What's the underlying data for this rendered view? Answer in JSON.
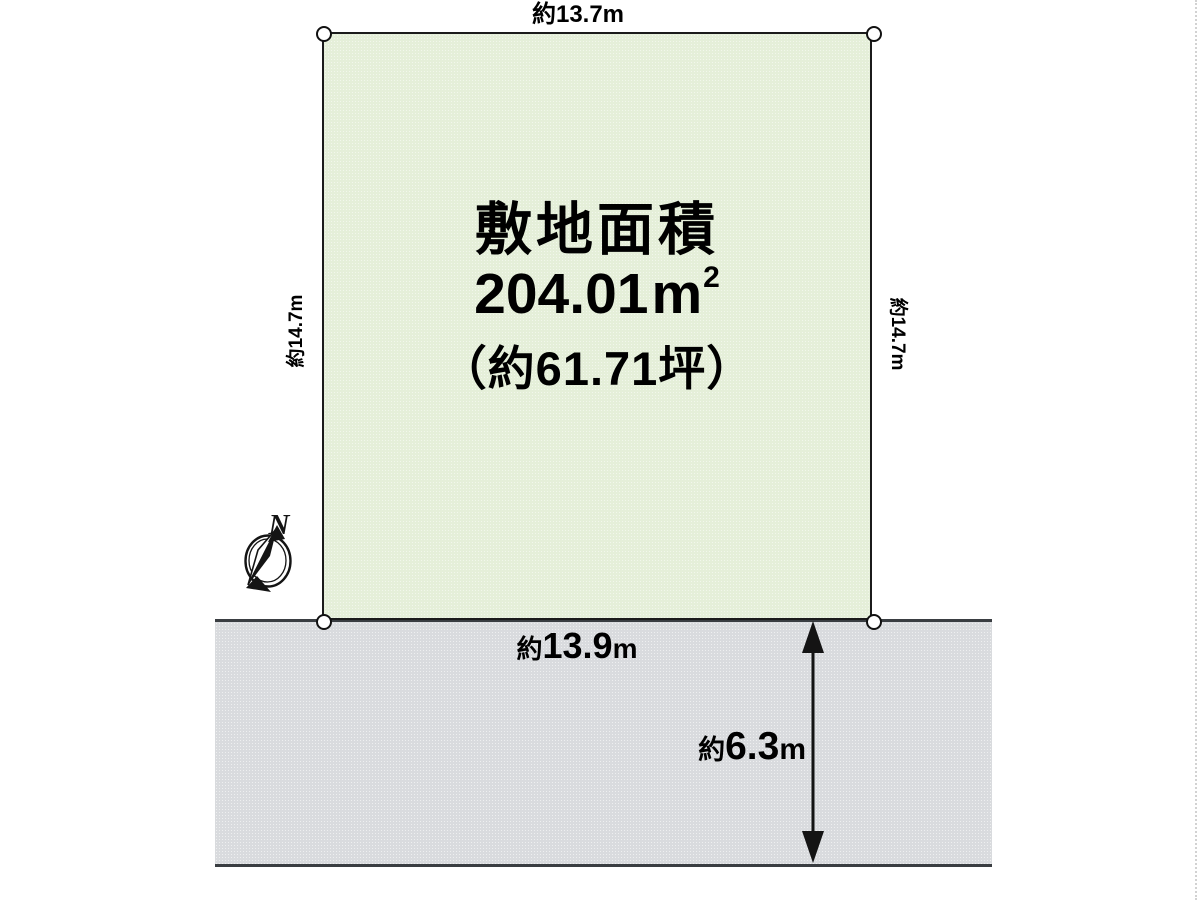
{
  "diagram": {
    "type": "land-plot-site-plan"
  },
  "plot": {
    "area_title": "敷地面積",
    "area_value": "204.01",
    "area_unit": "m",
    "area_unit_exp": "2",
    "area_tsubo": "（約61.71坪）",
    "dim_top": "約13.7m",
    "dim_left": "約14.7m",
    "dim_right": "約14.7m"
  },
  "road": {
    "frontage_prefix": "約",
    "frontage_value": "13.9",
    "frontage_unit": "m",
    "width_prefix": "約",
    "width_value": "6.3",
    "width_unit": "m"
  },
  "compass": {
    "north_label": "N"
  },
  "colors": {
    "plot_fill": "#e5efd9",
    "plot_border": "#1b1b1b",
    "road_fill": "#d9dbde",
    "road_line": "#3a3e42",
    "marker_fill": "#ffffff",
    "ink": "#141414"
  }
}
